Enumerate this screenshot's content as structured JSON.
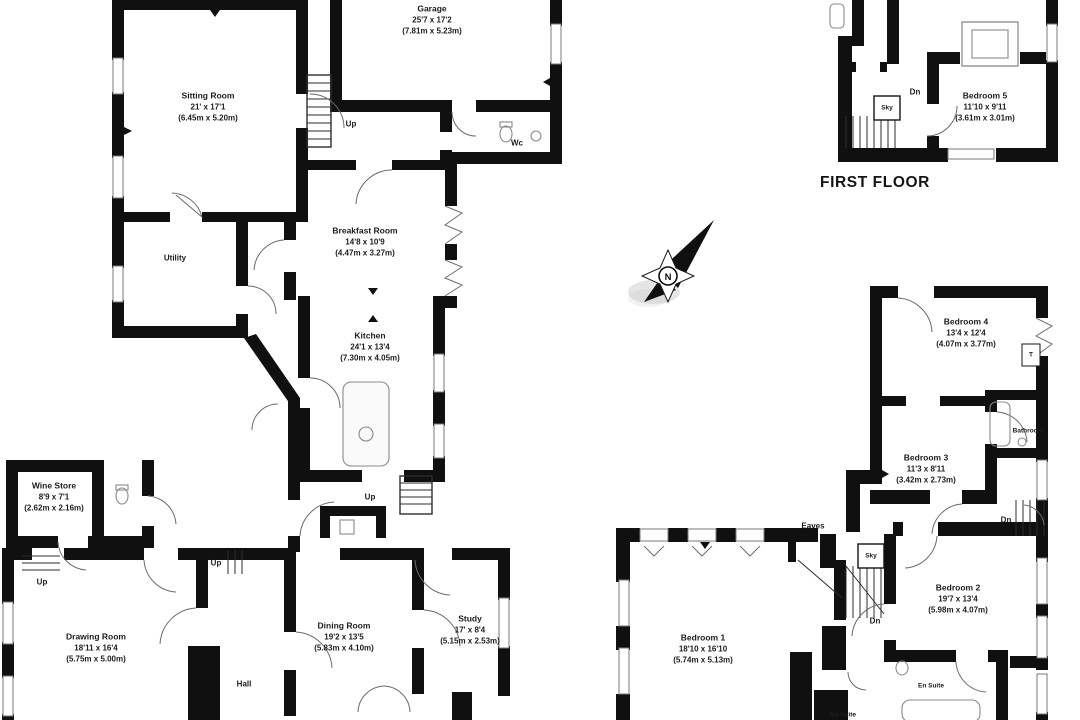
{
  "floorplan": {
    "floor_title": "FIRST FLOOR",
    "compass": {
      "letter": "N"
    },
    "rooms": [
      {
        "id": "sitting-room",
        "name": "Sitting Room",
        "imperial": "21' x 17'1",
        "metric": "(6.45m x 5.20m)"
      },
      {
        "id": "garage",
        "name": "Garage",
        "imperial": "25'7 x 17'2",
        "metric": "(7.81m x 5.23m)"
      },
      {
        "id": "breakfast-room",
        "name": "Breakfast Room",
        "imperial": "14'8 x 10'9",
        "metric": "(4.47m x 3.27m)"
      },
      {
        "id": "kitchen",
        "name": "Kitchen",
        "imperial": "24'1 x 13'4",
        "metric": "(7.30m x 4.05m)"
      },
      {
        "id": "wine-store",
        "name": "Wine Store",
        "imperial": "8'9 x 7'1",
        "metric": "(2.62m x 2.16m)"
      },
      {
        "id": "drawing-room",
        "name": "Drawing Room",
        "imperial": "18'11 x 16'4",
        "metric": "(5.75m x 5.00m)"
      },
      {
        "id": "dining-room",
        "name": "Dining Room",
        "imperial": "19'2 x 13'5",
        "metric": "(5.83m x 4.10m)"
      },
      {
        "id": "study",
        "name": "Study",
        "imperial": "17' x 8'4",
        "metric": "(5.15m x 2.53m)"
      },
      {
        "id": "bedroom-5",
        "name": "Bedroom 5",
        "imperial": "11'10 x 9'11",
        "metric": "(3.61m x 3.01m)"
      },
      {
        "id": "bedroom-4",
        "name": "Bedroom 4",
        "imperial": "13'4 x 12'4",
        "metric": "(4.07m x 3.77m)"
      },
      {
        "id": "bedroom-3",
        "name": "Bedroom 3",
        "imperial": "11'3 x 8'11",
        "metric": "(3.42m x 2.73m)"
      },
      {
        "id": "bedroom-2",
        "name": "Bedroom 2",
        "imperial": "19'7 x 13'4",
        "metric": "(5.98m x 4.07m)"
      },
      {
        "id": "bedroom-1",
        "name": "Bedroom 1",
        "imperial": "18'10 x 16'10",
        "metric": "(5.74m x 5.13m)"
      }
    ],
    "labels": {
      "up": "Up",
      "dn": "Dn",
      "sky": "Sky",
      "wc": "Wc",
      "t": "T",
      "hall": "Hall",
      "utility": "Utility",
      "eaves": "Eaves",
      "bathroom": "Bathroom",
      "en_suite": "En Suite"
    }
  },
  "colors": {
    "wall": "#101010",
    "text": "#1c1c1c",
    "background": "#ffffff",
    "fixture": "#8a8a8a",
    "door_arc": "#666666"
  }
}
